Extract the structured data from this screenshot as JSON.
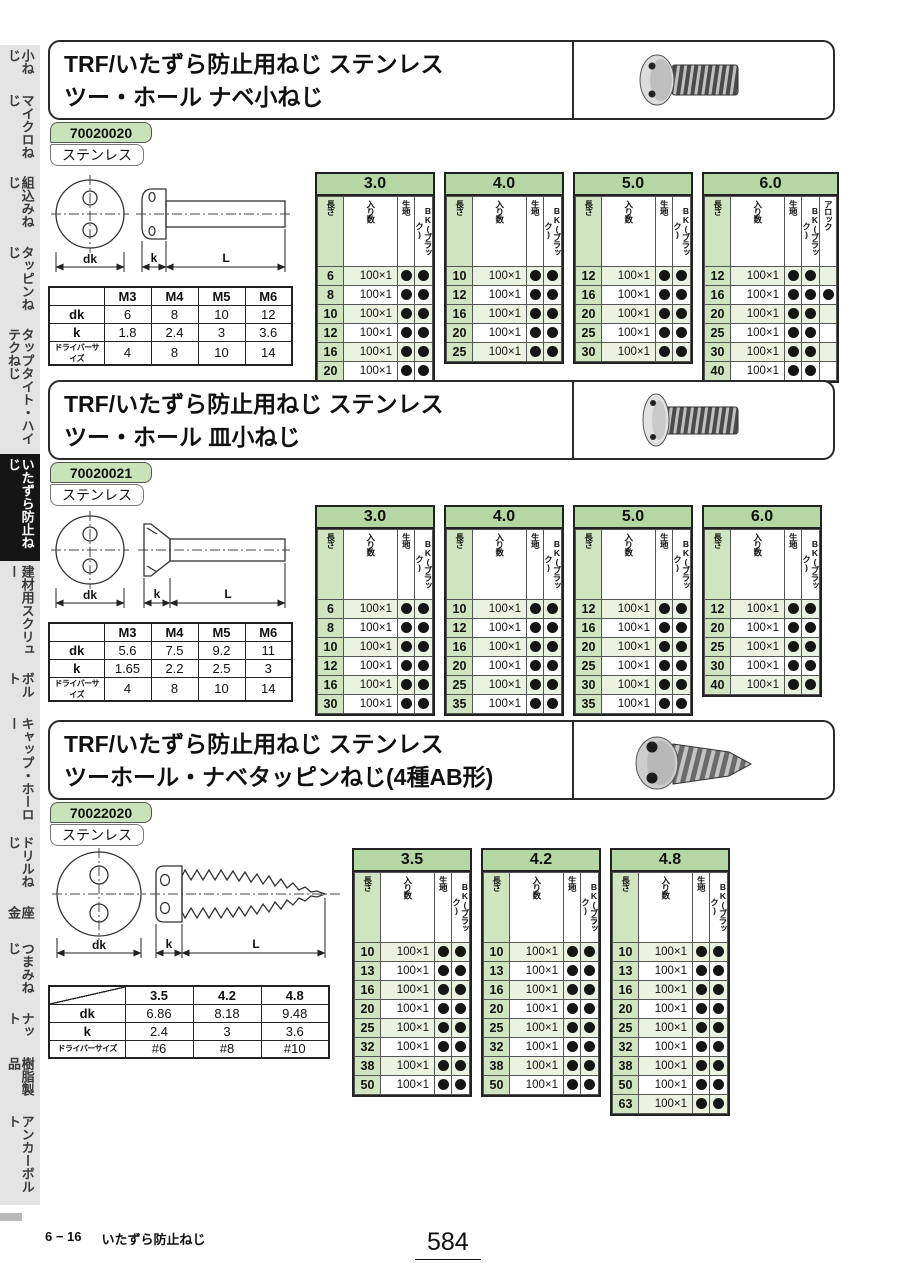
{
  "colors": {
    "header_green": "#b4d7a4",
    "row_green": "#e9f3e0",
    "len_green": "#cfe5bf",
    "badge_green": "#c8e3b8",
    "tab_gray": "#e4e4e4",
    "selected_black": "#151515"
  },
  "sidebar": {
    "items": [
      {
        "label": "小ねじ",
        "selected": false
      },
      {
        "label": "マイクロねじ",
        "selected": false
      },
      {
        "label": "組込みねじ",
        "selected": false
      },
      {
        "label": "タッピンねじ",
        "selected": false
      },
      {
        "label": "タップタイト・ハイテクねじ",
        "selected": false
      },
      {
        "label": "いたずら防止ねじ",
        "selected": true
      },
      {
        "label": "建材用スクリュー",
        "selected": false
      },
      {
        "label": "ボルト",
        "selected": false
      },
      {
        "label": "キャップ・ホーロー",
        "selected": false
      },
      {
        "label": "ドリルねじ",
        "selected": false
      },
      {
        "label": "座 金",
        "selected": false
      },
      {
        "label": "つまみねじ",
        "selected": false
      },
      {
        "label": "ナット",
        "selected": false
      },
      {
        "label": "樹脂製品",
        "selected": false
      },
      {
        "label": "アンカーボルト",
        "selected": false
      }
    ]
  },
  "sections": [
    {
      "title_line1": "TRF/いたずら防止用ねじ ステンレス",
      "title_line2": "ツー・ホール ナベ小ねじ",
      "code": "70020020",
      "material": "ステンレス",
      "drawing_labels": {
        "dk": "dk",
        "k": "k",
        "L": "L"
      },
      "dim_table": {
        "diagonal": false,
        "cols": [
          "M3",
          "M4",
          "M5",
          "M6"
        ],
        "rows": [
          [
            "dk",
            "6",
            "8",
            "10",
            "12"
          ],
          [
            "k",
            "1.8",
            "2.4",
            "3",
            "3.6"
          ],
          [
            "ドライバーサイズ",
            "4",
            "8",
            "10",
            "14"
          ]
        ]
      },
      "size_tables": [
        {
          "size": "3.0",
          "cols": [
            "長さ",
            "入り数",
            "生地",
            "BK(ブラック)"
          ],
          "rows": [
            [
              "6",
              "100×1",
              1,
              1
            ],
            [
              "8",
              "100×1",
              1,
              1
            ],
            [
              "10",
              "100×1",
              1,
              1
            ],
            [
              "12",
              "100×1",
              1,
              1
            ],
            [
              "16",
              "100×1",
              1,
              1
            ],
            [
              "20",
              "100×1",
              1,
              1
            ]
          ]
        },
        {
          "size": "4.0",
          "cols": [
            "長さ",
            "入り数",
            "生地",
            "BK(ブラック)"
          ],
          "rows": [
            [
              "10",
              "100×1",
              1,
              1
            ],
            [
              "12",
              "100×1",
              1,
              1
            ],
            [
              "16",
              "100×1",
              1,
              1
            ],
            [
              "20",
              "100×1",
              1,
              1
            ],
            [
              "25",
              "100×1",
              1,
              1
            ]
          ]
        },
        {
          "size": "5.0",
          "cols": [
            "長さ",
            "入り数",
            "生地",
            "BK(ブラック)"
          ],
          "rows": [
            [
              "12",
              "100×1",
              1,
              1
            ],
            [
              "16",
              "100×1",
              1,
              1
            ],
            [
              "20",
              "100×1",
              1,
              1
            ],
            [
              "25",
              "100×1",
              1,
              1
            ],
            [
              "30",
              "100×1",
              1,
              1
            ]
          ]
        },
        {
          "size": "6.0",
          "cols": [
            "長さ",
            "入り数",
            "生地",
            "BK(ブラック)",
            "アロック"
          ],
          "rows": [
            [
              "12",
              "100×1",
              1,
              1,
              0
            ],
            [
              "16",
              "100×1",
              1,
              1,
              1
            ],
            [
              "20",
              "100×1",
              1,
              1,
              0
            ],
            [
              "25",
              "100×1",
              1,
              1,
              0
            ],
            [
              "30",
              "100×1",
              1,
              1,
              0
            ],
            [
              "40",
              "100×1",
              1,
              1,
              0
            ]
          ]
        }
      ]
    },
    {
      "title_line1": "TRF/いたずら防止用ねじ ステンレス",
      "title_line2": "ツー・ホール 皿小ねじ",
      "code": "70020021",
      "material": "ステンレス",
      "drawing_labels": {
        "dk": "dk",
        "k": "k",
        "L": "L"
      },
      "dim_table": {
        "diagonal": false,
        "cols": [
          "M3",
          "M4",
          "M5",
          "M6"
        ],
        "rows": [
          [
            "dk",
            "5.6",
            "7.5",
            "9.2",
            "11"
          ],
          [
            "k",
            "1.65",
            "2.2",
            "2.5",
            "3"
          ],
          [
            "ドライバーサイズ",
            "4",
            "8",
            "10",
            "14"
          ]
        ]
      },
      "size_tables": [
        {
          "size": "3.0",
          "cols": [
            "長さ",
            "入り数",
            "生地",
            "BK(ブラック)"
          ],
          "rows": [
            [
              "6",
              "100×1",
              1,
              1
            ],
            [
              "8",
              "100×1",
              1,
              1
            ],
            [
              "10",
              "100×1",
              1,
              1
            ],
            [
              "12",
              "100×1",
              1,
              1
            ],
            [
              "16",
              "100×1",
              1,
              1
            ],
            [
              "30",
              "100×1",
              1,
              1
            ]
          ]
        },
        {
          "size": "4.0",
          "cols": [
            "長さ",
            "入り数",
            "生地",
            "BK(ブラック)"
          ],
          "rows": [
            [
              "10",
              "100×1",
              1,
              1
            ],
            [
              "12",
              "100×1",
              1,
              1
            ],
            [
              "16",
              "100×1",
              1,
              1
            ],
            [
              "20",
              "100×1",
              1,
              1
            ],
            [
              "25",
              "100×1",
              1,
              1
            ],
            [
              "35",
              "100×1",
              1,
              1
            ]
          ]
        },
        {
          "size": "5.0",
          "cols": [
            "長さ",
            "入り数",
            "生地",
            "BK(ブラック)"
          ],
          "rows": [
            [
              "12",
              "100×1",
              1,
              1
            ],
            [
              "16",
              "100×1",
              1,
              1
            ],
            [
              "20",
              "100×1",
              1,
              1
            ],
            [
              "25",
              "100×1",
              1,
              1
            ],
            [
              "30",
              "100×1",
              1,
              1
            ],
            [
              "35",
              "100×1",
              1,
              1
            ]
          ]
        },
        {
          "size": "6.0",
          "cols": [
            "長さ",
            "入り数",
            "生地",
            "BK(ブラック)"
          ],
          "rows": [
            [
              "12",
              "100×1",
              1,
              1
            ],
            [
              "20",
              "100×1",
              1,
              1
            ],
            [
              "25",
              "100×1",
              1,
              1
            ],
            [
              "30",
              "100×1",
              1,
              1
            ],
            [
              "40",
              "100×1",
              1,
              1
            ]
          ]
        }
      ]
    },
    {
      "title_line1": "TRF/いたずら防止用ねじ ステンレス",
      "title_line2": "ツーホール・ナベタッピンねじ(4種AB形)",
      "code": "70022020",
      "material": "ステンレス",
      "drawing_labels": {
        "dk": "dk",
        "k": "k",
        "L": "L"
      },
      "dim_table": {
        "diagonal": true,
        "cols": [
          "3.5",
          "4.2",
          "4.8"
        ],
        "rows": [
          [
            "dk",
            "6.86",
            "8.18",
            "9.48"
          ],
          [
            "k",
            "2.4",
            "3",
            "3.6"
          ],
          [
            "ドライバーサイズ",
            "#6",
            "#8",
            "#10"
          ]
        ]
      },
      "size_tables": [
        {
          "size": "3.5",
          "cols": [
            "長さ",
            "入り数",
            "生地",
            "BK(ブラック)"
          ],
          "rows": [
            [
              "10",
              "100×1",
              1,
              1
            ],
            [
              "13",
              "100×1",
              1,
              1
            ],
            [
              "16",
              "100×1",
              1,
              1
            ],
            [
              "20",
              "100×1",
              1,
              1
            ],
            [
              "25",
              "100×1",
              1,
              1
            ],
            [
              "32",
              "100×1",
              1,
              1
            ],
            [
              "38",
              "100×1",
              1,
              1
            ],
            [
              "50",
              "100×1",
              1,
              1
            ]
          ]
        },
        {
          "size": "4.2",
          "cols": [
            "長さ",
            "入り数",
            "生地",
            "BK(ブラック)"
          ],
          "rows": [
            [
              "10",
              "100×1",
              1,
              1
            ],
            [
              "13",
              "100×1",
              1,
              1
            ],
            [
              "16",
              "100×1",
              1,
              1
            ],
            [
              "20",
              "100×1",
              1,
              1
            ],
            [
              "25",
              "100×1",
              1,
              1
            ],
            [
              "32",
              "100×1",
              1,
              1
            ],
            [
              "38",
              "100×1",
              1,
              1
            ],
            [
              "50",
              "100×1",
              1,
              1
            ]
          ]
        },
        {
          "size": "4.8",
          "cols": [
            "長さ",
            "入り数",
            "生地",
            "BK(ブラック)"
          ],
          "rows": [
            [
              "10",
              "100×1",
              1,
              1
            ],
            [
              "13",
              "100×1",
              1,
              1
            ],
            [
              "16",
              "100×1",
              1,
              1
            ],
            [
              "20",
              "100×1",
              1,
              1
            ],
            [
              "25",
              "100×1",
              1,
              1
            ],
            [
              "32",
              "100×1",
              1,
              1
            ],
            [
              "38",
              "100×1",
              1,
              1
            ],
            [
              "50",
              "100×1",
              1,
              1
            ],
            [
              "63",
              "100×1",
              1,
              1
            ]
          ]
        }
      ]
    }
  ],
  "footer": {
    "section_no": "6 − 16",
    "section_name": "いたずら防止ねじ",
    "page_number": "584"
  }
}
